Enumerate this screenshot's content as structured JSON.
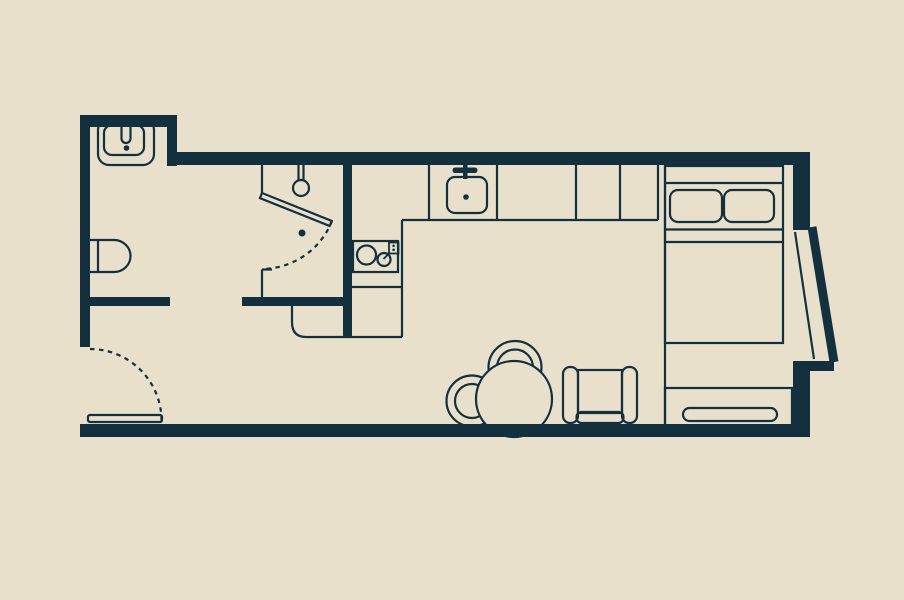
{
  "description": "Studio apartment floor plan drawing",
  "canvas": {
    "width": 904,
    "height": 600
  },
  "colors": {
    "background": "#e8e0cb",
    "line": "#13303f"
  },
  "fixtures": [
    "bathroom-sink",
    "toilet",
    "shower-head",
    "shower-drain",
    "shower-pivot-door",
    "entry-door",
    "kitchen-counter",
    "cooktop",
    "kitchen-sink",
    "dining-table",
    "dining-chair-top",
    "dining-chair-left",
    "armchair",
    "double-bed",
    "pillow-left",
    "pillow-right",
    "media-cabinet",
    "angled-window"
  ]
}
